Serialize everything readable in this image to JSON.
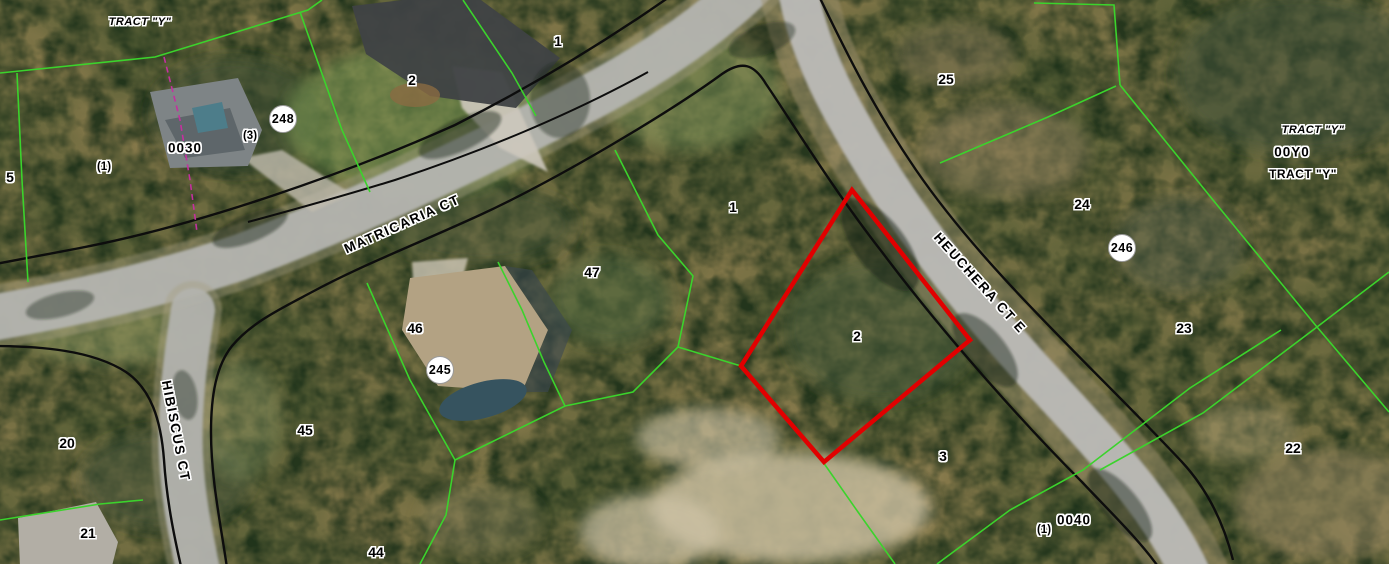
{
  "map": {
    "width": 1389,
    "height": 564,
    "selected_parcel": {
      "number": "2",
      "outline_color": "#e10000"
    },
    "colors": {
      "parcel_line": "#3bd32c",
      "right_of_way_line": "#0d0d0d",
      "selected_outline": "#e10000",
      "survey_line": "#c4309f",
      "badge_bg": "#ffffff",
      "label_text": "#000000"
    },
    "street_names": [
      "MATRICARIA CT",
      "HIBISCUS CT",
      "HEUCHERA CT E"
    ],
    "labels": [
      {
        "type": "tract",
        "text": "TRACT \"Y\"",
        "x": 140,
        "y": 22,
        "rot": 0
      },
      {
        "type": "parcel-number",
        "text": "1",
        "x": 558,
        "y": 41,
        "rot": 0
      },
      {
        "type": "parcel-number",
        "text": "2",
        "x": 412,
        "y": 80,
        "rot": 0
      },
      {
        "type": "parcel-number",
        "text": "25",
        "x": 946,
        "y": 79,
        "rot": 0
      },
      {
        "type": "parcel-number",
        "text": "5",
        "x": 10,
        "y": 177,
        "rot": 0
      },
      {
        "type": "sub",
        "text": "(1)",
        "x": 104,
        "y": 167,
        "rot": 0
      },
      {
        "type": "code",
        "text": "0030",
        "x": 185,
        "y": 148,
        "rot": 0
      },
      {
        "type": "sub",
        "text": "(3)",
        "x": 250,
        "y": 136,
        "rot": 0
      },
      {
        "type": "street",
        "text": "MATRICARIA CT",
        "x": 402,
        "y": 224,
        "rot": -24
      },
      {
        "type": "parcel-number",
        "text": "47",
        "x": 592,
        "y": 272,
        "rot": 0
      },
      {
        "type": "parcel-number",
        "text": "1",
        "x": 733,
        "y": 207,
        "rot": 0
      },
      {
        "type": "parcel-number",
        "text": "46",
        "x": 415,
        "y": 328,
        "rot": 0
      },
      {
        "type": "parcel-number",
        "text": "2",
        "x": 857,
        "y": 336,
        "rot": 0
      },
      {
        "type": "street",
        "text": "HEUCHERA CT E",
        "x": 980,
        "y": 283,
        "rot": 48
      },
      {
        "type": "parcel-number",
        "text": "24",
        "x": 1082,
        "y": 204,
        "rot": 0
      },
      {
        "type": "parcel-number",
        "text": "23",
        "x": 1184,
        "y": 328,
        "rot": 0
      },
      {
        "type": "tract",
        "text": "TRACT \"Y\"",
        "x": 1313,
        "y": 130,
        "rot": 0
      },
      {
        "type": "code",
        "text": "00Y0",
        "x": 1292,
        "y": 152,
        "rot": 0
      },
      {
        "type": "tract-bold",
        "text": "TRACT \"Y\"",
        "x": 1303,
        "y": 174,
        "rot": 0
      },
      {
        "type": "parcel-number",
        "text": "22",
        "x": 1293,
        "y": 448,
        "rot": 0
      },
      {
        "type": "parcel-number",
        "text": "20",
        "x": 67,
        "y": 443,
        "rot": 0
      },
      {
        "type": "street",
        "text": "HIBISCUS CT",
        "x": 176,
        "y": 431,
        "rot": 79
      },
      {
        "type": "parcel-number",
        "text": "21",
        "x": 88,
        "y": 533,
        "rot": 0
      },
      {
        "type": "parcel-number",
        "text": "45",
        "x": 305,
        "y": 430,
        "rot": 0
      },
      {
        "type": "parcel-number",
        "text": "44",
        "x": 376,
        "y": 552,
        "rot": 0
      },
      {
        "type": "parcel-number",
        "text": "3",
        "x": 943,
        "y": 456,
        "rot": 0
      },
      {
        "type": "code",
        "text": "0040",
        "x": 1074,
        "y": 520,
        "rot": 0
      },
      {
        "type": "sub",
        "text": "(1)",
        "x": 1044,
        "y": 530,
        "rot": 0
      }
    ],
    "marker_badges": [
      {
        "text": "248",
        "x": 283,
        "y": 119
      },
      {
        "text": "245",
        "x": 440,
        "y": 370
      },
      {
        "text": "246",
        "x": 1122,
        "y": 248
      }
    ]
  }
}
